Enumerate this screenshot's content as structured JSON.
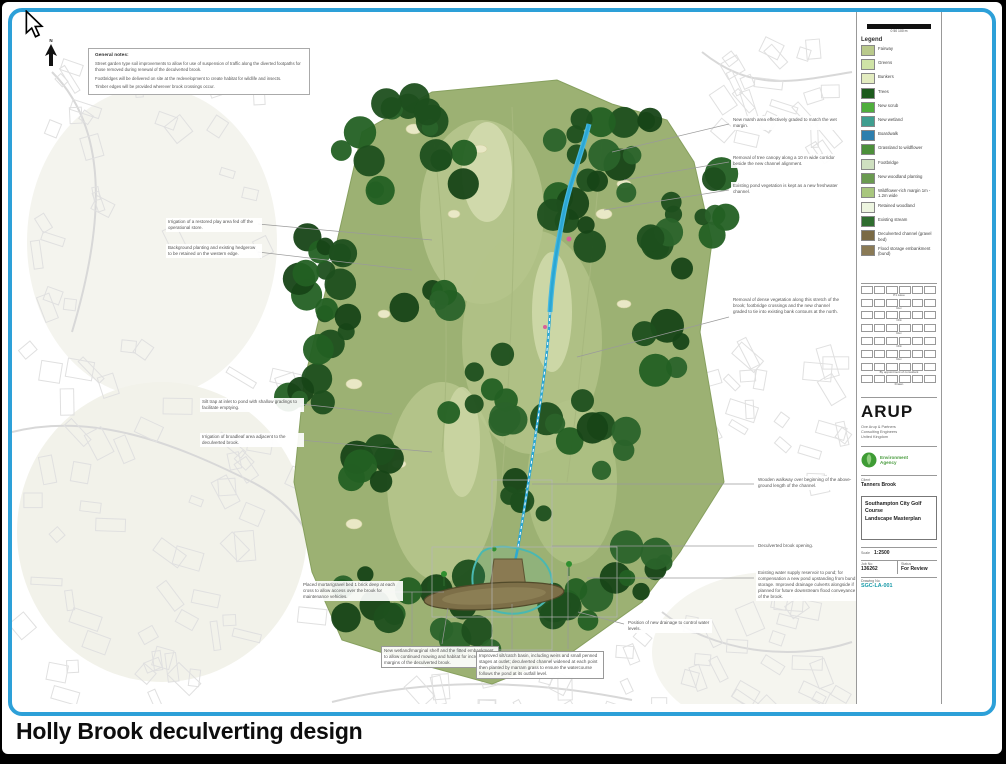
{
  "caption": "Holly Brook deculverting design",
  "north": {
    "label": "N"
  },
  "notes": {
    "title": "General notes:",
    "paragraphs": [
      "Street garden type soil improvements to allow for use of suspension of traffic along the diverted footpaths for those removed during renewal of the deculverted brook.",
      "Footbridges will be delivered on site at the redevelopment to create habitat for wildlife and insects.",
      "Timber edges will be provided wherever brook crossings occur."
    ]
  },
  "colors": {
    "frame_blue": "#2da0d8",
    "course_green": "#9cb173",
    "tree_green": "#1d4f1d",
    "stream_blue": "#2ba7d4",
    "pond_brown": "#7d6f48",
    "drawing_no_teal": "#189aa8"
  },
  "map": {
    "annotations": [
      {
        "x": 154,
        "y": 206,
        "w": 92,
        "text": "Irrigation of a restored play area fed off the operational store.",
        "border": false
      },
      {
        "x": 154,
        "y": 232,
        "w": 92,
        "text": "Background planting and existing hedgerow to be retained on the western edge.",
        "border": false
      },
      {
        "x": 188,
        "y": 386,
        "w": 100,
        "text": "Silt trap at inlet to pond with shallow gradings to facilitate emptying.",
        "border": false
      },
      {
        "x": 188,
        "y": 421,
        "w": 100,
        "text": "Irrigation of broadleaf area adjacent to the deculverted brook.",
        "border": false
      },
      {
        "x": 289,
        "y": 569,
        "w": 98,
        "text": "Placed mortar/gravel bed 1 brick deep at each cross to allow access over the brook for maintenance vehicles.",
        "border": false
      },
      {
        "x": 719,
        "y": 104,
        "w": 110,
        "text": "New marsh area effectively graded to match the wet margin.",
        "border": false
      },
      {
        "x": 719,
        "y": 142,
        "w": 110,
        "text": "Removal of tree canopy along a 10 m wide corridor beside the new channel alignment.",
        "border": false
      },
      {
        "x": 719,
        "y": 170,
        "w": 110,
        "text": "Existing pond vegetation is kept as a new freshwater channel.",
        "border": false
      },
      {
        "x": 719,
        "y": 284,
        "w": 110,
        "text": "Removal of dense vegetation along this stretch of the brook; footbridge crossings and the new channel graded to tie into existing bank contours at the north.",
        "border": false
      },
      {
        "x": 744,
        "y": 464,
        "w": 100,
        "text": "Wooden walkway over beginning of the above-ground length of the channel.",
        "border": false
      },
      {
        "x": 744,
        "y": 530,
        "w": 100,
        "text": "Deculverted brook opening.",
        "border": false
      },
      {
        "x": 744,
        "y": 557,
        "w": 100,
        "text": "Existing water supply reservoir to pond; for compensation a new pond upstanding from bund storage. Improved drainage culverts alongside if planned for future downstream flood conveyance of the brook.",
        "border": false
      },
      {
        "x": 369,
        "y": 634,
        "w": 112,
        "text": "New wetland/marginal shelf and the fitted embankment to allow continued mowing and habitat for increased margins of the deculverted brook.",
        "border": true
      },
      {
        "x": 464,
        "y": 639,
        "w": 122,
        "text": "Improved silt/catch basin, including weirs and small penned stages at outlet; deculverted channel widened at each point then planted by marram grass to ensure the watercourse follows the pond at its outfall level.",
        "border": true
      },
      {
        "x": 614,
        "y": 607,
        "w": 82,
        "text": "Position of new drainage to control water levels.",
        "border": false
      }
    ],
    "leaders": [
      [
        246,
        212,
        420,
        228
      ],
      [
        246,
        240,
        400,
        258
      ],
      [
        288,
        392,
        380,
        402
      ],
      [
        288,
        428,
        420,
        440
      ],
      [
        355,
        580,
        432,
        580
      ],
      [
        717,
        112,
        600,
        140
      ],
      [
        717,
        150,
        612,
        168
      ],
      [
        717,
        178,
        592,
        198
      ],
      [
        717,
        305,
        565,
        345
      ],
      [
        742,
        472,
        520,
        472
      ],
      [
        742,
        534,
        540,
        534
      ],
      [
        742,
        566,
        575,
        566
      ],
      [
        400,
        632,
        400,
        580
      ],
      [
        430,
        632,
        436,
        596
      ],
      [
        500,
        637,
        500,
        592
      ],
      [
        556,
        637,
        556,
        556
      ],
      [
        612,
        612,
        566,
        600
      ]
    ],
    "rects": [
      [
        420,
        535,
        185,
        70
      ],
      [
        480,
        468,
        60,
        170
      ]
    ]
  },
  "scalebar": {
    "caption": "0    50    100 m"
  },
  "legend": {
    "title": "Legend",
    "items": [
      {
        "label": "Fairway",
        "color": "#b9c98b"
      },
      {
        "label": "Greens",
        "color": "#cfe3a6"
      },
      {
        "label": "Bunkers",
        "color": "#e3ecc0"
      },
      {
        "label": "Trees",
        "color": "#1c5a1c"
      },
      {
        "label": "New scrub",
        "color": "#4fae3c"
      },
      {
        "label": "New wetland",
        "color": "#3f9e8f"
      },
      {
        "label": "Boardwalk",
        "color": "#2e7fae"
      },
      {
        "label": "Grassland to wildflower",
        "color": "#4c8f3a"
      },
      {
        "label": "Footbridge",
        "color": "#cfe0c0"
      },
      {
        "label": "New woodland planting",
        "color": "#6a9a50"
      },
      {
        "label": "Wildflower-rich margin 1m - 1.2m wide",
        "color": "#a8c67e"
      },
      {
        "label": "Retained woodland",
        "color": "#edf5e0"
      },
      {
        "label": "Existing stream",
        "color": "#2f6d2f"
      },
      {
        "label": "Deculverted channel (gravel bed)",
        "color": "#7a6a45"
      },
      {
        "label": "Flood storage embankment (bund)",
        "color": "#8a7a55"
      }
    ]
  },
  "revisions": {
    "rows": [
      {
        "caption": "P1 issue"
      },
      {
        "caption": "Rev"
      },
      {
        "caption": "Chk"
      },
      {
        "caption": "Rev"
      },
      {
        "caption": "Chk"
      },
      {
        "caption": "Rev"
      },
      {
        "caption": "By appointment of consultant"
      },
      {
        "caption": "Drawn"
      }
    ]
  },
  "titleblock": {
    "firm": "ARUP",
    "address_lines": [
      "Ove Arup & Partners",
      "Consulting Engineers",
      "United Kingdom"
    ],
    "agency_line1": "Environment",
    "agency_line2": "Agency",
    "client_label": "Client",
    "client_value": "Tanners Brook",
    "title_line1": "Southampton City Golf Course",
    "title_line2": "Landscape Masterplan",
    "scale_label": "Scale",
    "scale_value": "1:2500",
    "job_label": "Job No",
    "job_value": "136262",
    "status_label": "Status",
    "status_value": "For Review",
    "drawno_label": "Drawing No",
    "drawno_value": "SGC-LA-001"
  }
}
